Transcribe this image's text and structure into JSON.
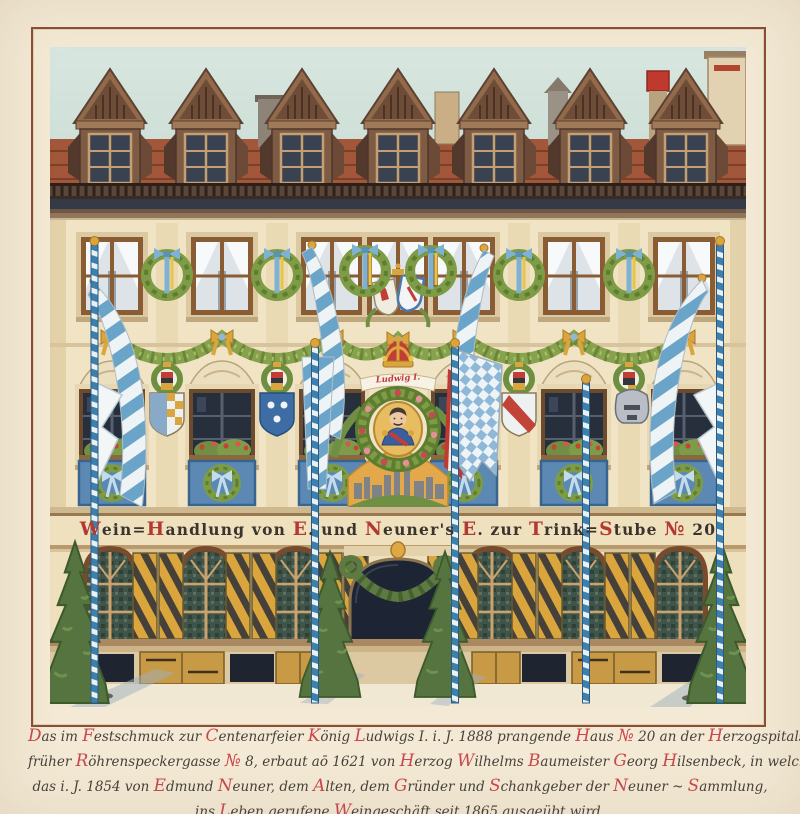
{
  "page": {
    "background": "#f3e9d4",
    "frame_color": "#8a4f38"
  },
  "painting": {
    "dormer_count": 7,
    "upper_window_count": 7,
    "middle_window_count": 6,
    "ground_arch_count": 6,
    "maypole_count": 5,
    "tree_count": 4,
    "colors": {
      "sky": "#cfe0d8",
      "roof_tile": "#a2573a",
      "facade": "#f1e4c4",
      "garland_green": "#87a24c",
      "ribbon_blue": "#6aa4c8",
      "shutter_yellow": "#d9a53c",
      "pole_blue": "#3d80ad",
      "tree_green": "#55743f",
      "panel_blue": "#5c88b4"
    },
    "banner": {
      "text": "Wein=Handlung von E. und Neuner's E. zur Trink=Stube № 20",
      "ink": "#3a332e",
      "initial": "#b23a32"
    },
    "medallion": {
      "label": "Ludwig I.",
      "label_color": "#c23a3a"
    }
  },
  "caption": {
    "ink": "#46413c",
    "initial": "#c9474e",
    "lines": [
      "Das im Festschmuck zur Centenarfeier König Ludwigs I. i. J. 1888 prangende Haus № 20 an der Herzogspitalstrasse,",
      "früher Röhrenspeckergasse № 8, erbaut aō 1621 von Herzog Wilhelms Baumeister Georg Hilsenbeck, in welchem",
      "das i. J. 1854 von Edmund Neuner, dem Alten, dem Gründer und Schankgeber der Neuner ~ Sammlung,",
      "ins Leben gerufene Weingeschäft seit 1865 ausgeübt wird."
    ]
  }
}
